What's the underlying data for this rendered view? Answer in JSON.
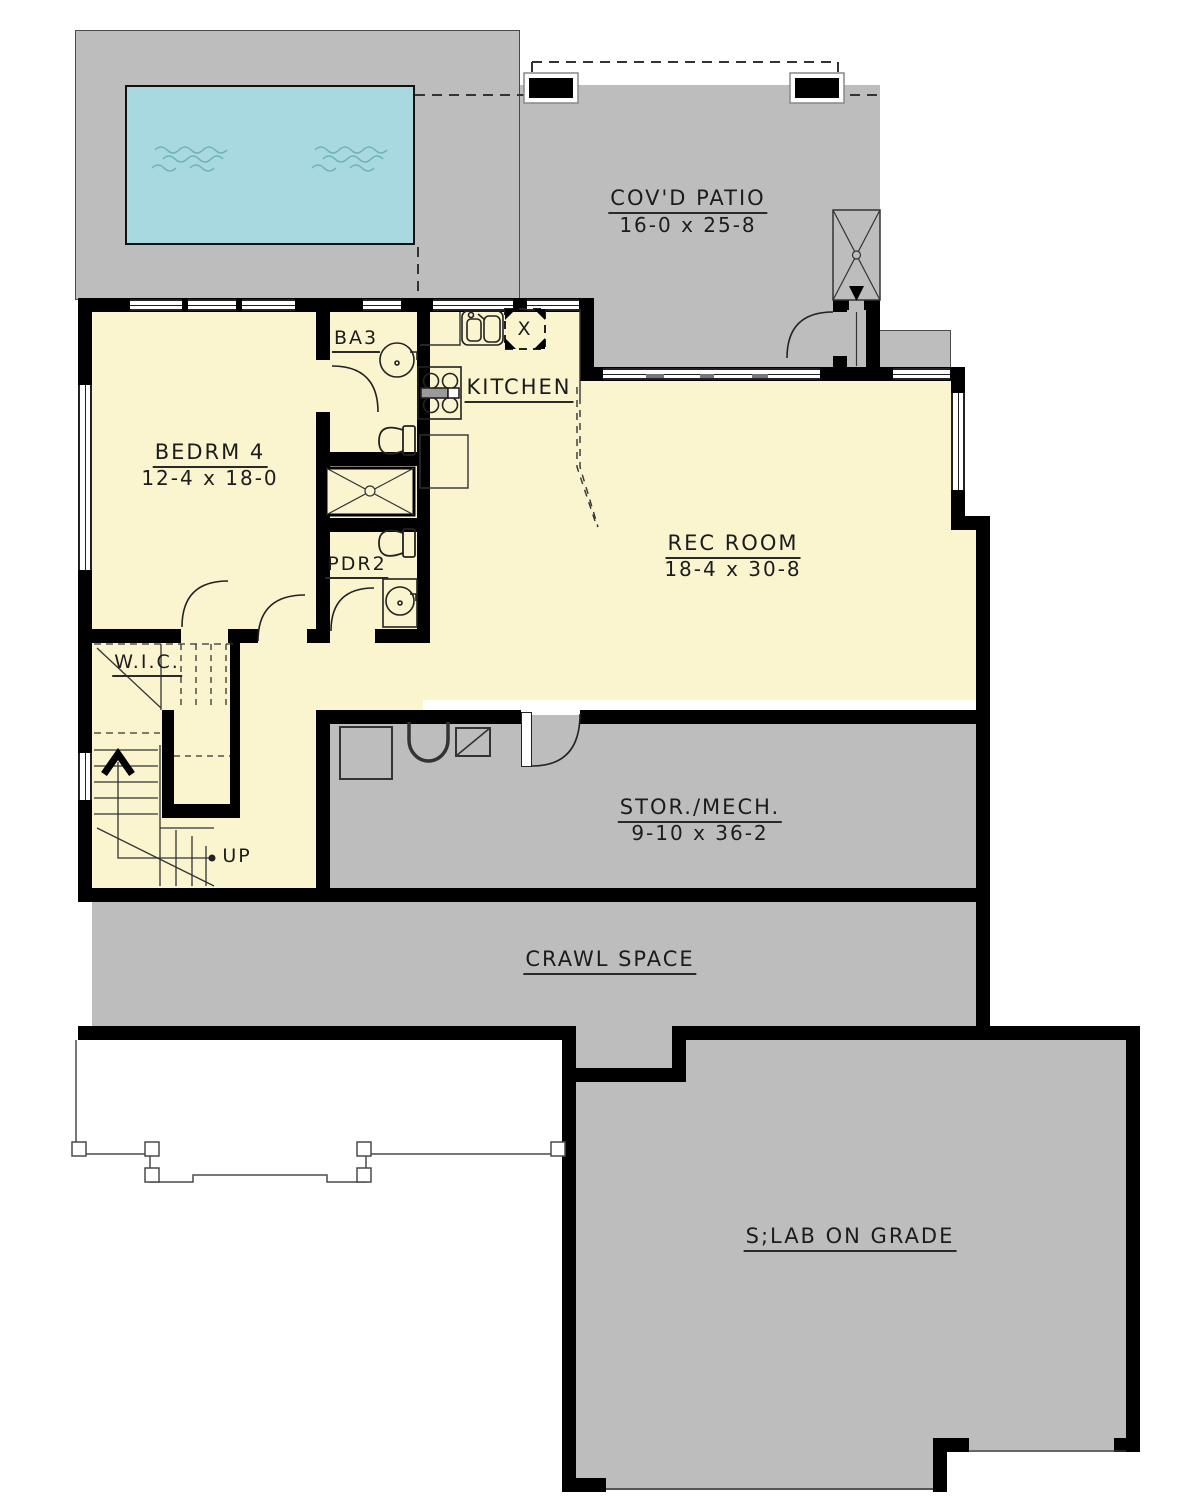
{
  "plan": {
    "title": "Basement floor plan",
    "rooms": {
      "covd_patio": {
        "name": "COV'D PATIO",
        "dims": "16-0 x 25-8"
      },
      "bedrm4": {
        "name": "BEDRM 4",
        "dims": "12-4 x 18-0"
      },
      "ba3": {
        "name": "BA3"
      },
      "kitchen": {
        "name": "KITCHEN"
      },
      "rec_room": {
        "name": "REC ROOM",
        "dims": "18-4 x 30-8"
      },
      "pdr2": {
        "name": "PDR2"
      },
      "wic": {
        "name": "W.I.C."
      },
      "stor_mech": {
        "name": "STOR./MECH.",
        "dims": "9-10 x 36-2"
      },
      "crawl_space": {
        "name": "CRAWL SPACE"
      },
      "slab_on_grade": {
        "name": "S;LAB ON GRADE"
      }
    },
    "annotations": {
      "up": "UP",
      "skylight_x": "X"
    },
    "colors": {
      "floor_yellow": "#faf5cf",
      "concrete_gray": "#bdbdbd",
      "pool_blue": "#a8d8e0",
      "wall_black": "#000000",
      "line_gray": "#333333"
    }
  }
}
